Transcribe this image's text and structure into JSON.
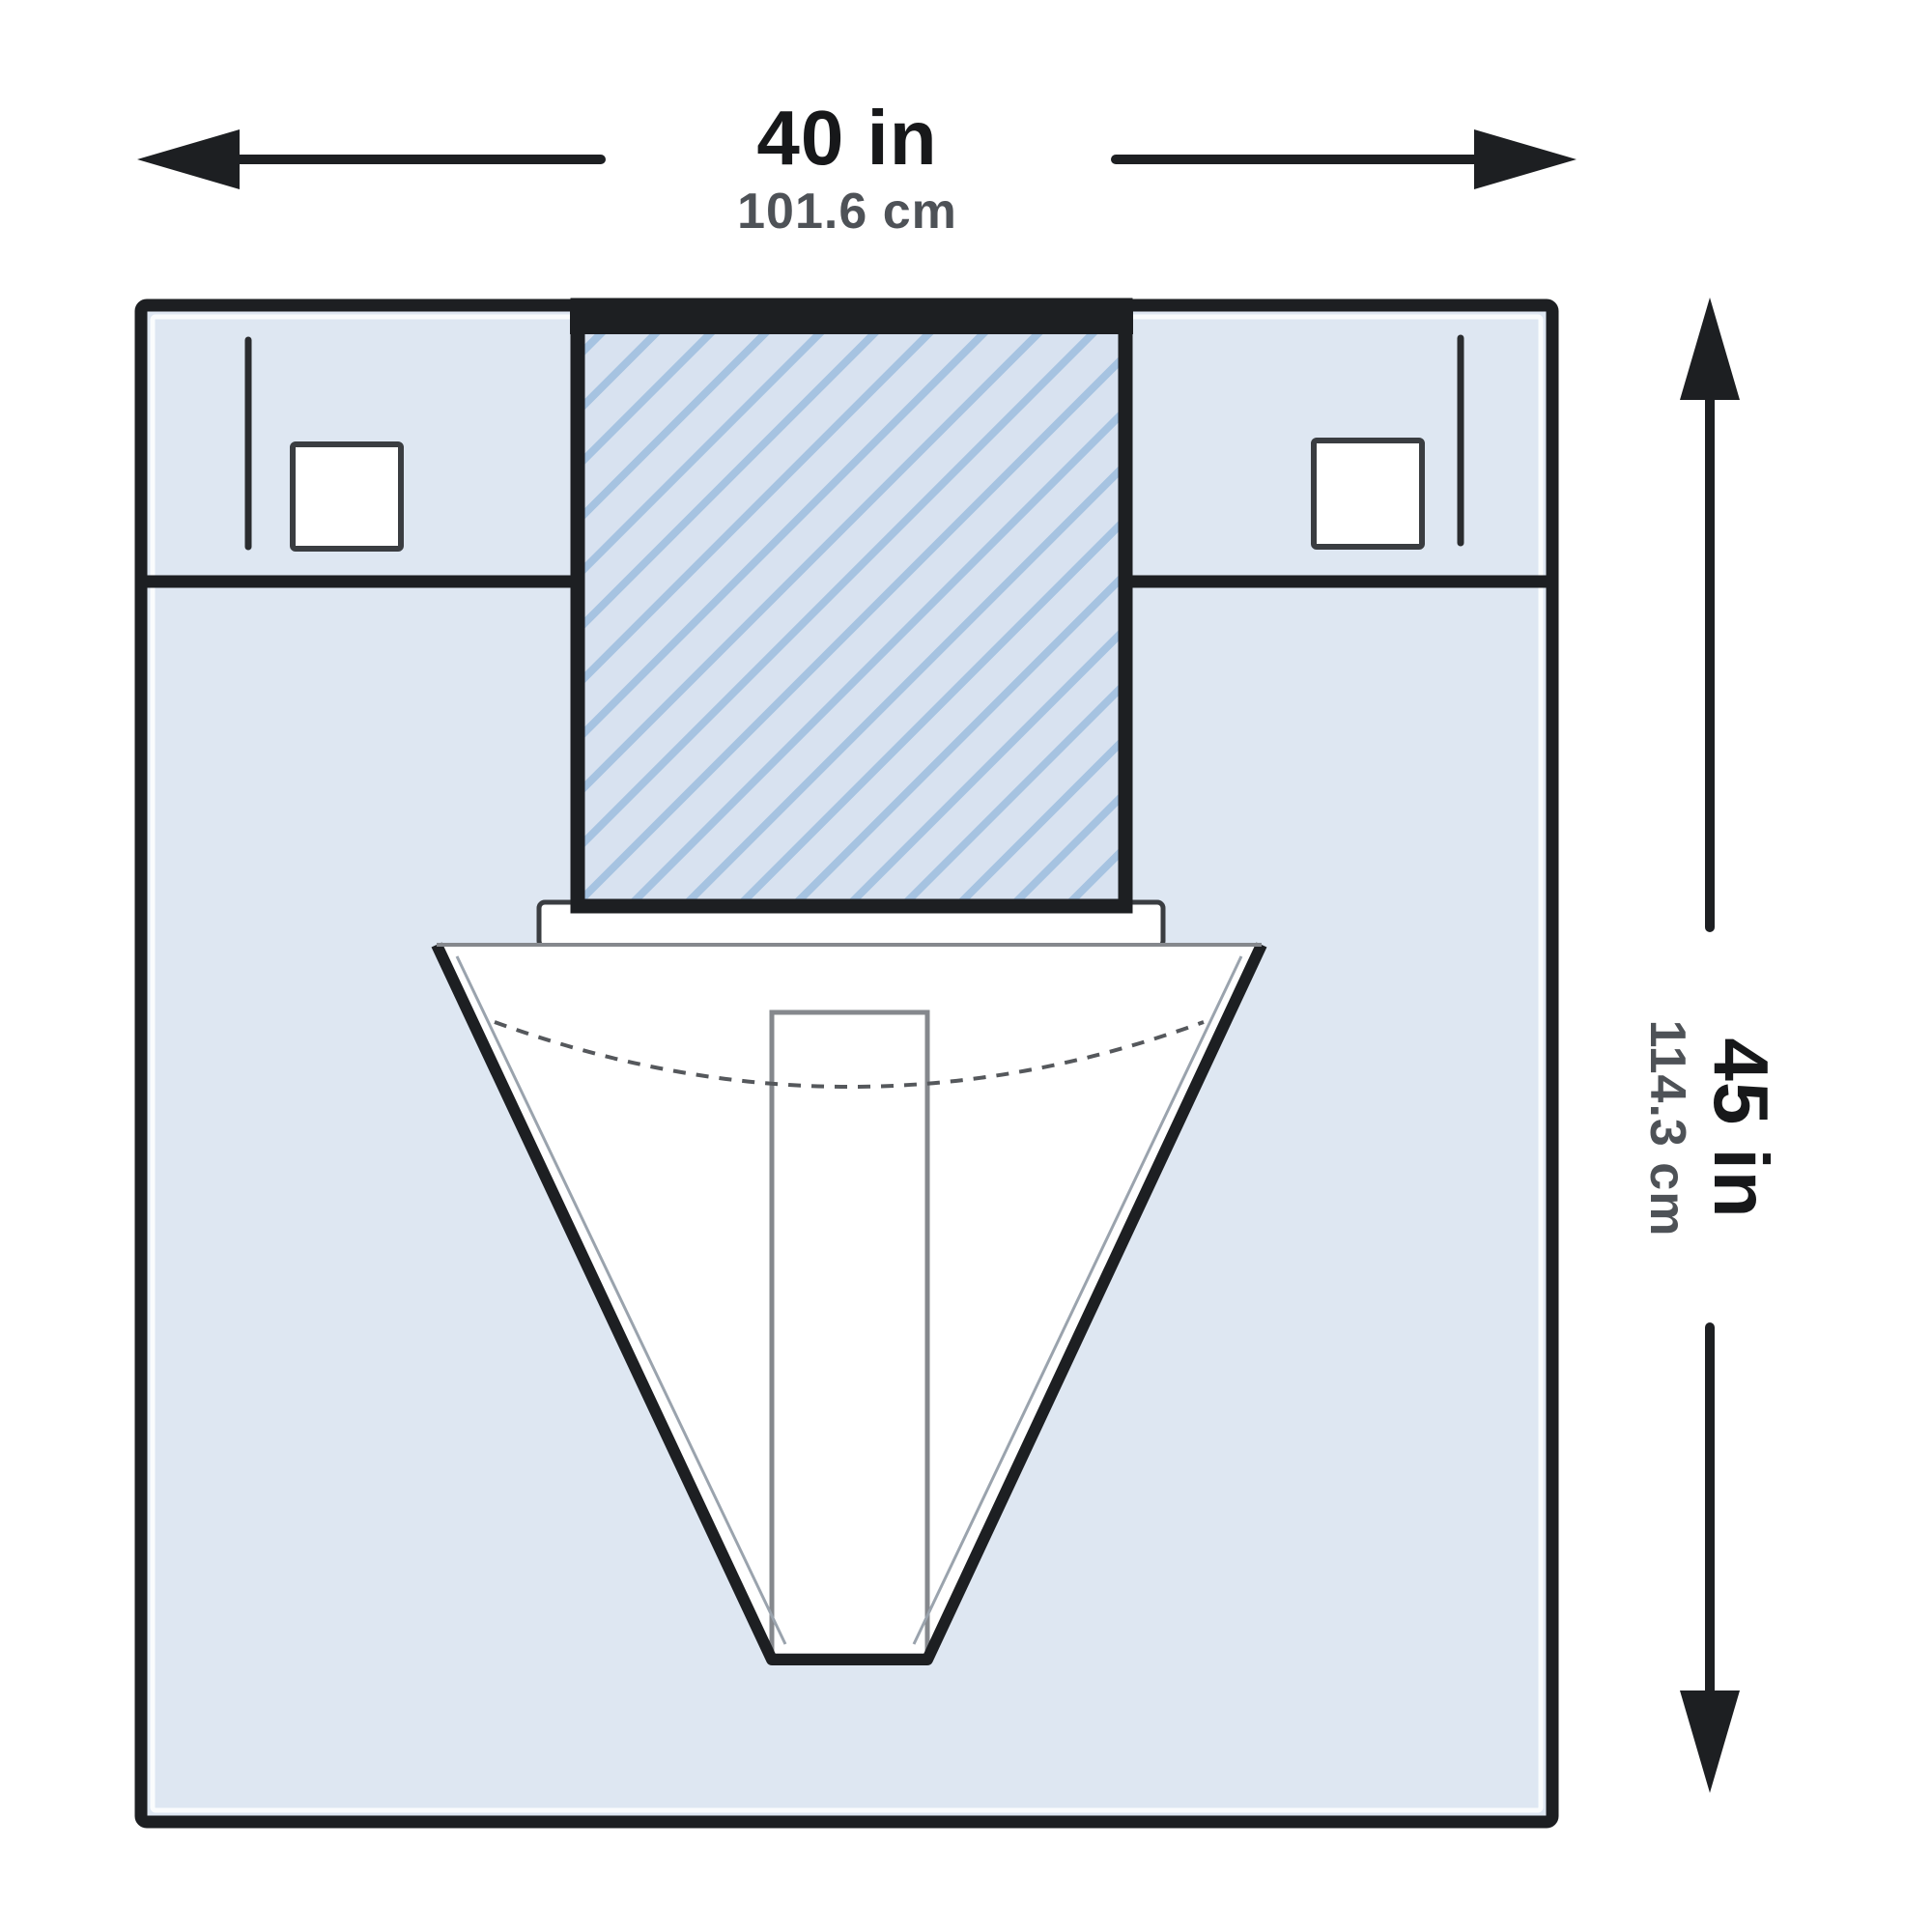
{
  "dimension_labels": {
    "width": {
      "inches": "40 in",
      "centimeters": "101.6 cm"
    },
    "height": {
      "inches": "45 in",
      "centimeters": "114.3 cm"
    }
  },
  "colors": {
    "background": "#ffffff",
    "drape_fill": "#dee7f2",
    "hatch_base": "#d8e2f0",
    "hatch_stripe": "#a6c3e1",
    "outline": "#1d1f22",
    "inner_line": "#9aa3ad",
    "primary_text": "#17181a",
    "secondary_text": "#4e5257",
    "white": "#ffffff"
  }
}
